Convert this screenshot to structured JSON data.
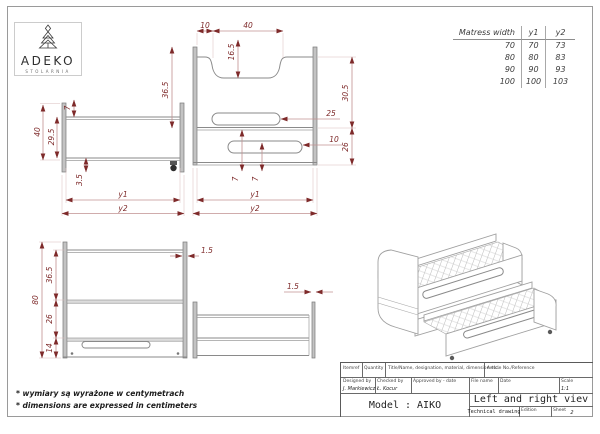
{
  "logo": {
    "brand": "ADEKO",
    "subtitle": "STOLARNIA"
  },
  "mattress_table": {
    "headers": [
      "Matress width",
      "y1",
      "y2"
    ],
    "rows": [
      [
        "70",
        "70",
        "73"
      ],
      [
        "80",
        "80",
        "83"
      ],
      [
        "90",
        "90",
        "93"
      ],
      [
        "100",
        "100",
        "103"
      ]
    ]
  },
  "dims": {
    "side_view": {
      "d7": "7",
      "d40": "40",
      "d29_5": "29.5",
      "d3_5": "3.5",
      "y1": "y1",
      "y2": "y2"
    },
    "right_view": {
      "d10_top": "10",
      "d40_top": "40",
      "d16_5": "16.5",
      "d36_5": "36.5",
      "d30_5": "30.5",
      "d25": "25",
      "d10_slot": "10",
      "d26": "26",
      "d7_a": "7",
      "d7_b": "7",
      "y1": "y1",
      "y2": "y2"
    },
    "front_view": {
      "d80": "80",
      "d36_5": "36.5",
      "d26": "26",
      "d14": "14",
      "d1_5_a": "1.5",
      "d1_5_b": "1.5"
    }
  },
  "title_block": {
    "itemref_label": "Itemref",
    "quantity_label": "Quantity",
    "title_label": "Title/Name, designation, material, dimension etc.",
    "article_label": "Article No./Reference",
    "designed_label": "Designed by",
    "designed_by": "J. Markiewicz",
    "checked_label": "Checked by",
    "checked_by": "Ł. Kocur",
    "approved_label": "Approved by - date",
    "file_label": "File name",
    "date_label": "Date",
    "scale_label": "Scale",
    "scale_value": "1:1",
    "model_label": "Model : AIKO",
    "drawing_title": "Left and right viev",
    "drawing_type": "Technical drawing",
    "edition_label": "Edition",
    "sheet_label": "Sheet",
    "sheet_value": "2"
  },
  "footnotes": {
    "pl": "* wymiary są wyrażone w centymetrach",
    "en": "* dimensions are expressed in centimeters"
  },
  "colors": {
    "dimension": "#7e2a2a",
    "drawing_line": "#8a8a8a"
  }
}
